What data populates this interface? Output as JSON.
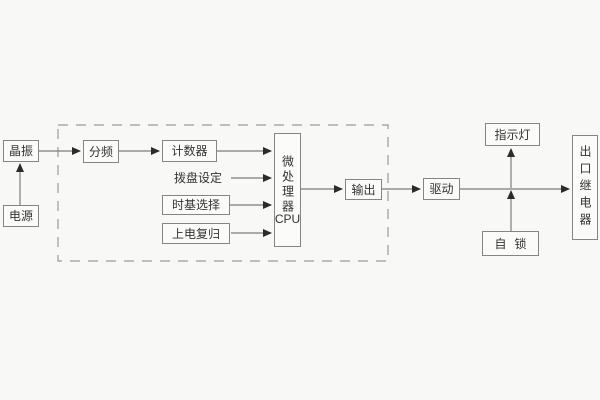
{
  "diagram": {
    "title": "timer-relay-logic-block-diagram",
    "colors": {
      "background": "#f8f8f6",
      "box_border": "#858585",
      "box_fill": "#fbfbfa",
      "text": "#333333",
      "wire": "#7c7c7c",
      "arrowhead": "#2b2b2b",
      "dashed_frame": "#9a9a9a"
    },
    "nodes": {
      "crystal": {
        "label": "晶振"
      },
      "power": {
        "label": "电源"
      },
      "divider": {
        "label": "分频"
      },
      "counter": {
        "label": "计数器"
      },
      "dial_setting": {
        "label": "拨盘设定"
      },
      "timebase_select": {
        "label": "时基选择"
      },
      "power_on_reset": {
        "label": "上电复归"
      },
      "cpu": {
        "label": "微处理器",
        "sublabel": "CPU"
      },
      "output": {
        "label": "输出"
      },
      "drive": {
        "label": "驱动"
      },
      "indicator_lamp": {
        "label": "指示灯"
      },
      "self_lock": {
        "label": "自锁"
      },
      "exit_relay": {
        "label": "出口继电器"
      }
    },
    "connections": [
      "电源 → 晶振",
      "晶振 → 分频",
      "分频 → 计数器",
      "计数器 → 微处理器CPU",
      "拨盘设定 → 微处理器CPU",
      "时基选择 → 微处理器CPU",
      "上电复归 → 微处理器CPU",
      "微处理器CPU → 输出",
      "输出 → 驱动",
      "驱动 → 出口继电器",
      "自锁 → 驱动输出线",
      "驱动输出线 → 指示灯"
    ]
  }
}
